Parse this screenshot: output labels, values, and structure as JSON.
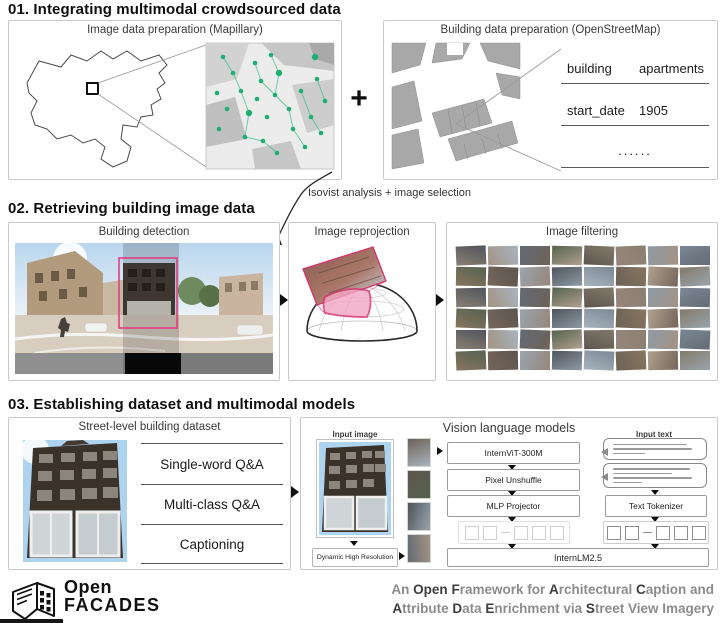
{
  "sections": {
    "s1": {
      "title": "01. Integrating multimodal crowdsourced data",
      "mapillary_panel": {
        "label": "Image data preparation (Mapillary)"
      },
      "plus_sign": "+",
      "osm_panel": {
        "label": "Building data preparation (OpenStreetMap)",
        "table": [
          {
            "key": "building",
            "value": "apartments"
          },
          {
            "key": "start_date",
            "value": "1905"
          },
          {
            "key": "......",
            "value": ""
          }
        ]
      },
      "annotation": "Isovist analysis + image selection"
    },
    "s2": {
      "title": "02. Retrieving building image data",
      "detection_panel": {
        "label": "Building detection"
      },
      "reprojection_panel": {
        "label": "Image reprojection"
      },
      "filtering_panel": {
        "label": "Image filtering"
      }
    },
    "s3": {
      "title": "03. Establishing dataset and multimodal models",
      "dataset_panel": {
        "label": "Street-level building dataset",
        "tasks": [
          "Single-word Q&A",
          "Multi-class Q&A",
          "Captioning"
        ]
      },
      "vlm_panel": {
        "label": "Vision language models",
        "input_image_label": "Input image",
        "dynamic_resolution_label": "Dynamic High Resolution",
        "vision_boxes": [
          "InternViT-300M",
          "Pixel Unshuffle",
          "MLP Projector"
        ],
        "input_text_label": "Input text",
        "tokenizer_label": "Text Tokenizer",
        "llm_label": "InternLM2.5"
      }
    }
  },
  "footer": {
    "logo_line1": "Open",
    "logo_line2": "FACADES",
    "tagline_line1": [
      {
        "t": "An ",
        "b": false
      },
      {
        "t": "Open",
        "b": true
      },
      {
        "t": " ",
        "b": false
      },
      {
        "t": "F",
        "b": true
      },
      {
        "t": "ramework for ",
        "b": false
      },
      {
        "t": "A",
        "b": true
      },
      {
        "t": "rchitectural ",
        "b": false
      },
      {
        "t": "C",
        "b": true
      },
      {
        "t": "aption and",
        "b": false
      }
    ],
    "tagline_line2": [
      {
        "t": "A",
        "b": true
      },
      {
        "t": "ttribute ",
        "b": false
      },
      {
        "t": "D",
        "b": true
      },
      {
        "t": "ata ",
        "b": false
      },
      {
        "t": "E",
        "b": true
      },
      {
        "t": "nrichment via ",
        "b": false
      },
      {
        "t": "S",
        "b": true
      },
      {
        "t": "treet View Imagery",
        "b": false
      }
    ]
  },
  "colors": {
    "accent_pink": "#e0407f",
    "mapillary_green": "#1fae74",
    "panel_border": "#c9c9c9",
    "osm_building_gray": "#a8a8a8",
    "tagline_gray": "#8c8c8c",
    "tagline_bold": "#3d3d3d",
    "photo_palette": [
      "#8a7f72",
      "#6d6257",
      "#9aa4ad",
      "#7b8894",
      "#5d564e",
      "#a49384",
      "#b0a18f",
      "#4f545c",
      "#86755f",
      "#97867a",
      "#636b75",
      "#827a6a",
      "#a8b4bd",
      "#75655a",
      "#8e9aa5",
      "#56624f"
    ]
  }
}
